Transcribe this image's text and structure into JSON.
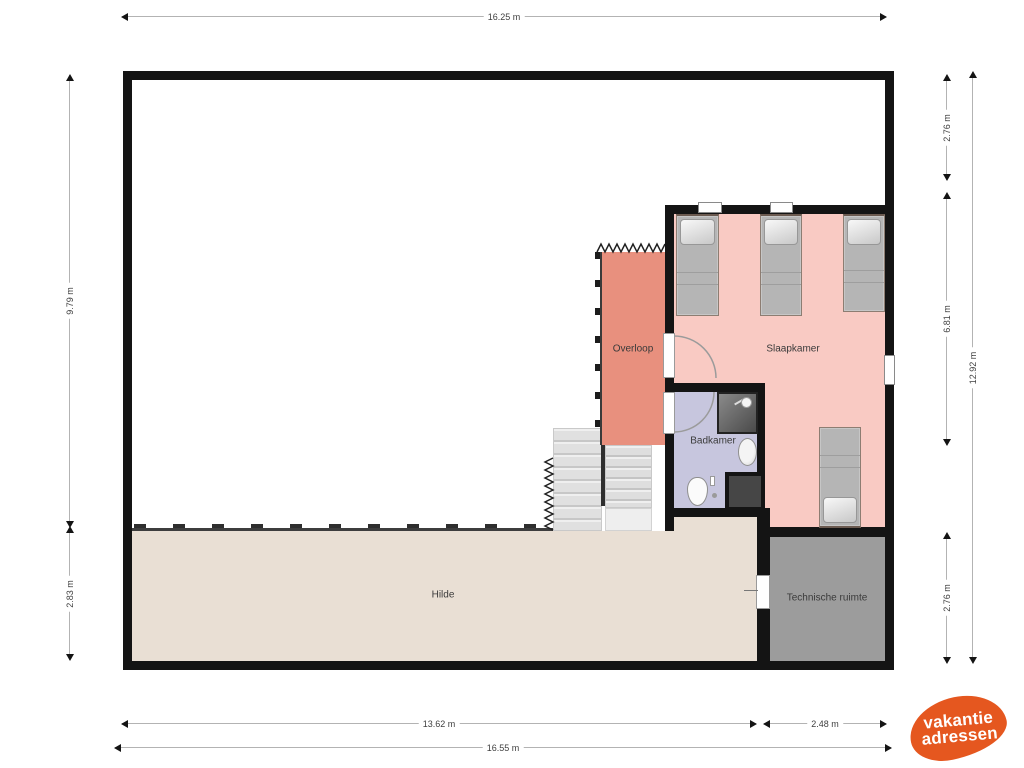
{
  "plan_title": "first-floor floorplan",
  "rooms": {
    "overloop": {
      "label": "Overloop",
      "color": "#e8907e"
    },
    "slaapkamer": {
      "label": "Slaapkamer",
      "color": "#f9cac3",
      "beds": 4
    },
    "badkamer": {
      "label": "Badkamer",
      "color": "#c7c6de",
      "fixtures": [
        "shower",
        "sink",
        "toilet"
      ]
    },
    "hilde": {
      "label": "Hilde",
      "color": "#e9dfd4"
    },
    "technische_ruimte": {
      "label": "Technische ruimte",
      "color": "#9c9c9c"
    }
  },
  "dimensions": {
    "top_total": "16.25 m",
    "left_upper": "9.79 m",
    "left_lower": "2.83 m",
    "right_upper": "2.76 m",
    "right_middle": "6.81 m",
    "right_lower": "2.76 m",
    "right_total": "12.92 m",
    "bottom_left": "13.62 m",
    "bottom_right": "2.48 m",
    "bottom_total": "16.55 m"
  },
  "colors": {
    "wall": "#141414",
    "stairs": "#e3e3e3",
    "logo_orange": "#e5571f"
  },
  "logo": {
    "line1": "vakantie",
    "line2": "adressen"
  }
}
